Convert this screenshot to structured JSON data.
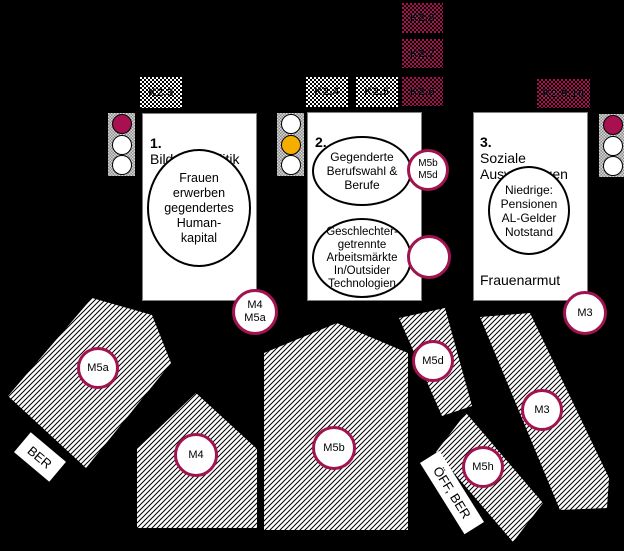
{
  "colors": {
    "background": "#000000",
    "accent_maroon": "#a81050",
    "badge_border": "#a0134f",
    "traffic_yellow": "#f5ae00",
    "box_fill": "#ffffff"
  },
  "context_factors": [
    {
      "label": "K2.3",
      "variant": "white-checker"
    },
    {
      "label": "K2.4",
      "variant": "white-checker"
    },
    {
      "label": "K2.5",
      "variant": "white-checker"
    },
    {
      "label": "K2.8",
      "variant": "red-checker"
    },
    {
      "label": "K2.7",
      "variant": "red-checker"
    },
    {
      "label": "K2.6",
      "variant": "red-checker"
    },
    {
      "label": "K2.9,10",
      "variant": "red-checker"
    }
  ],
  "sections": [
    {
      "number": "1.",
      "title": "Bildungspolitik",
      "traffic_light": [
        "red",
        "off",
        "off"
      ],
      "bubbles": [
        "Frauen\nerwerben\ngegendertes\nHuman-\nkapital"
      ]
    },
    {
      "number": "2.",
      "title": "Arbeitsmarkt",
      "traffic_light": [
        "off",
        "yellow",
        "off"
      ],
      "bubbles": [
        "Gegenderte\nBerufswahl &\nBerufe",
        "Geschlechter-\ngetrennte\nArbeitsmärkte\nIn/Outsider\nTechnologien"
      ]
    },
    {
      "number": "3.",
      "title": "Soziale\nAuswirkungen",
      "traffic_light": [
        "red",
        "off",
        "off"
      ],
      "bubbles": [
        "Niedrige:\nPensionen\nAL-Gelder\nNotstand"
      ],
      "caption": "Frauenarmut"
    }
  ],
  "badges": [
    {
      "id": "m5b-m5d",
      "label": "M5b\nM5d"
    },
    {
      "id": "empty",
      "label": ""
    },
    {
      "id": "m4-m5a",
      "label": "M4\nM5a"
    },
    {
      "id": "m3-top",
      "label": "M3"
    }
  ],
  "arrows": [
    {
      "id": "m5a",
      "label": "M5a"
    },
    {
      "id": "m4",
      "label": "M4"
    },
    {
      "id": "m5b",
      "label": "M5b"
    },
    {
      "id": "m5d",
      "label": "M5d"
    },
    {
      "id": "m5h",
      "label": "M5h"
    },
    {
      "id": "m3",
      "label": "M3"
    }
  ],
  "tags": [
    {
      "label": "BER"
    },
    {
      "label": "ÖFF, BER"
    }
  ]
}
